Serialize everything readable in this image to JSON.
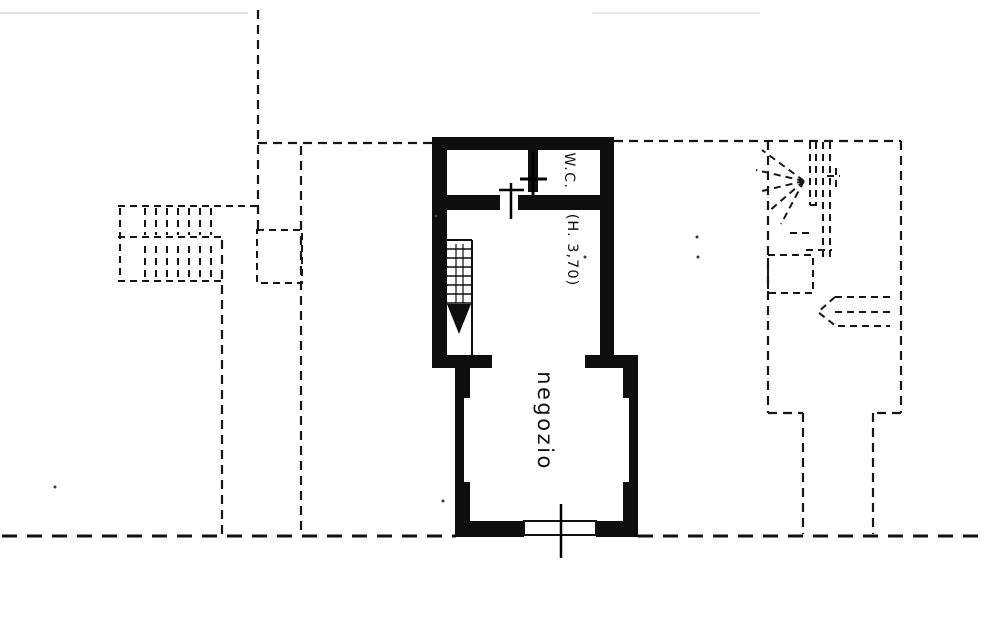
{
  "plan": {
    "labels": {
      "wc": "W.C.",
      "height_note": "(H. 3,70)",
      "shop": "negozio"
    },
    "colors": {
      "ink": "#161616",
      "wall": "#0e0e0e",
      "paper": "#ffffff"
    }
  }
}
